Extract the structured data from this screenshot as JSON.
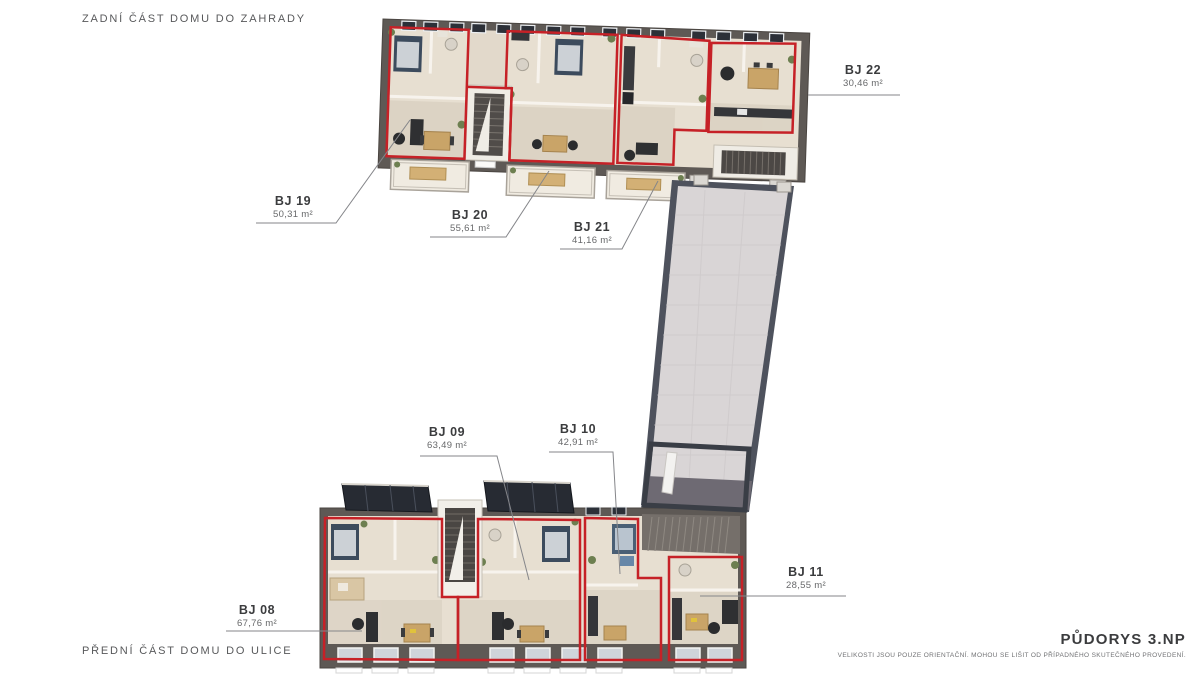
{
  "annotations": {
    "back_section": "ZADNÍ ČÁST DOMU DO ZAHRADY",
    "front_section": "PŘEDNÍ ČÁST DOMU DO ULICE"
  },
  "titleblock": {
    "title": "PŮDORYS 3.NP",
    "disclaimer": "VELIKOSTI JSOU POUZE ORIENTAČNÍ. MOHOU SE LIŠIT OD PŘÍPADNÉHO SKUTEČNÉHO PROVEDENÍ."
  },
  "units": [
    {
      "id": "BJ 19",
      "area": "50,31 m²",
      "building": "back"
    },
    {
      "id": "BJ 20",
      "area": "55,61 m²",
      "building": "back"
    },
    {
      "id": "BJ 21",
      "area": "41,16 m²",
      "building": "back"
    },
    {
      "id": "BJ 22",
      "area": "30,46 m²",
      "building": "back"
    },
    {
      "id": "BJ 08",
      "area": "67,76 m²",
      "building": "front"
    },
    {
      "id": "BJ 09",
      "area": "63,49 m²",
      "building": "front"
    },
    {
      "id": "BJ 10",
      "area": "42,91 m²",
      "building": "front"
    },
    {
      "id": "BJ 11",
      "area": "28,55 m²",
      "building": "front"
    }
  ],
  "colors": {
    "wall": "#5e5955",
    "floor": "#e7dfd1",
    "unit_outline_red": "#c62127",
    "corridor_tile": "#d9d5d6",
    "corridor_frame": "#4e525d",
    "glass_dark": "#272b33",
    "furniture_dark": "#2f3032",
    "bed_navy": "#3c4b5d",
    "table_tan": "#c9a468",
    "plant_green": "#6d7f50",
    "leader_line": "#85868a",
    "title_text": "#3b3c3e",
    "muted_text": "#67686a"
  }
}
